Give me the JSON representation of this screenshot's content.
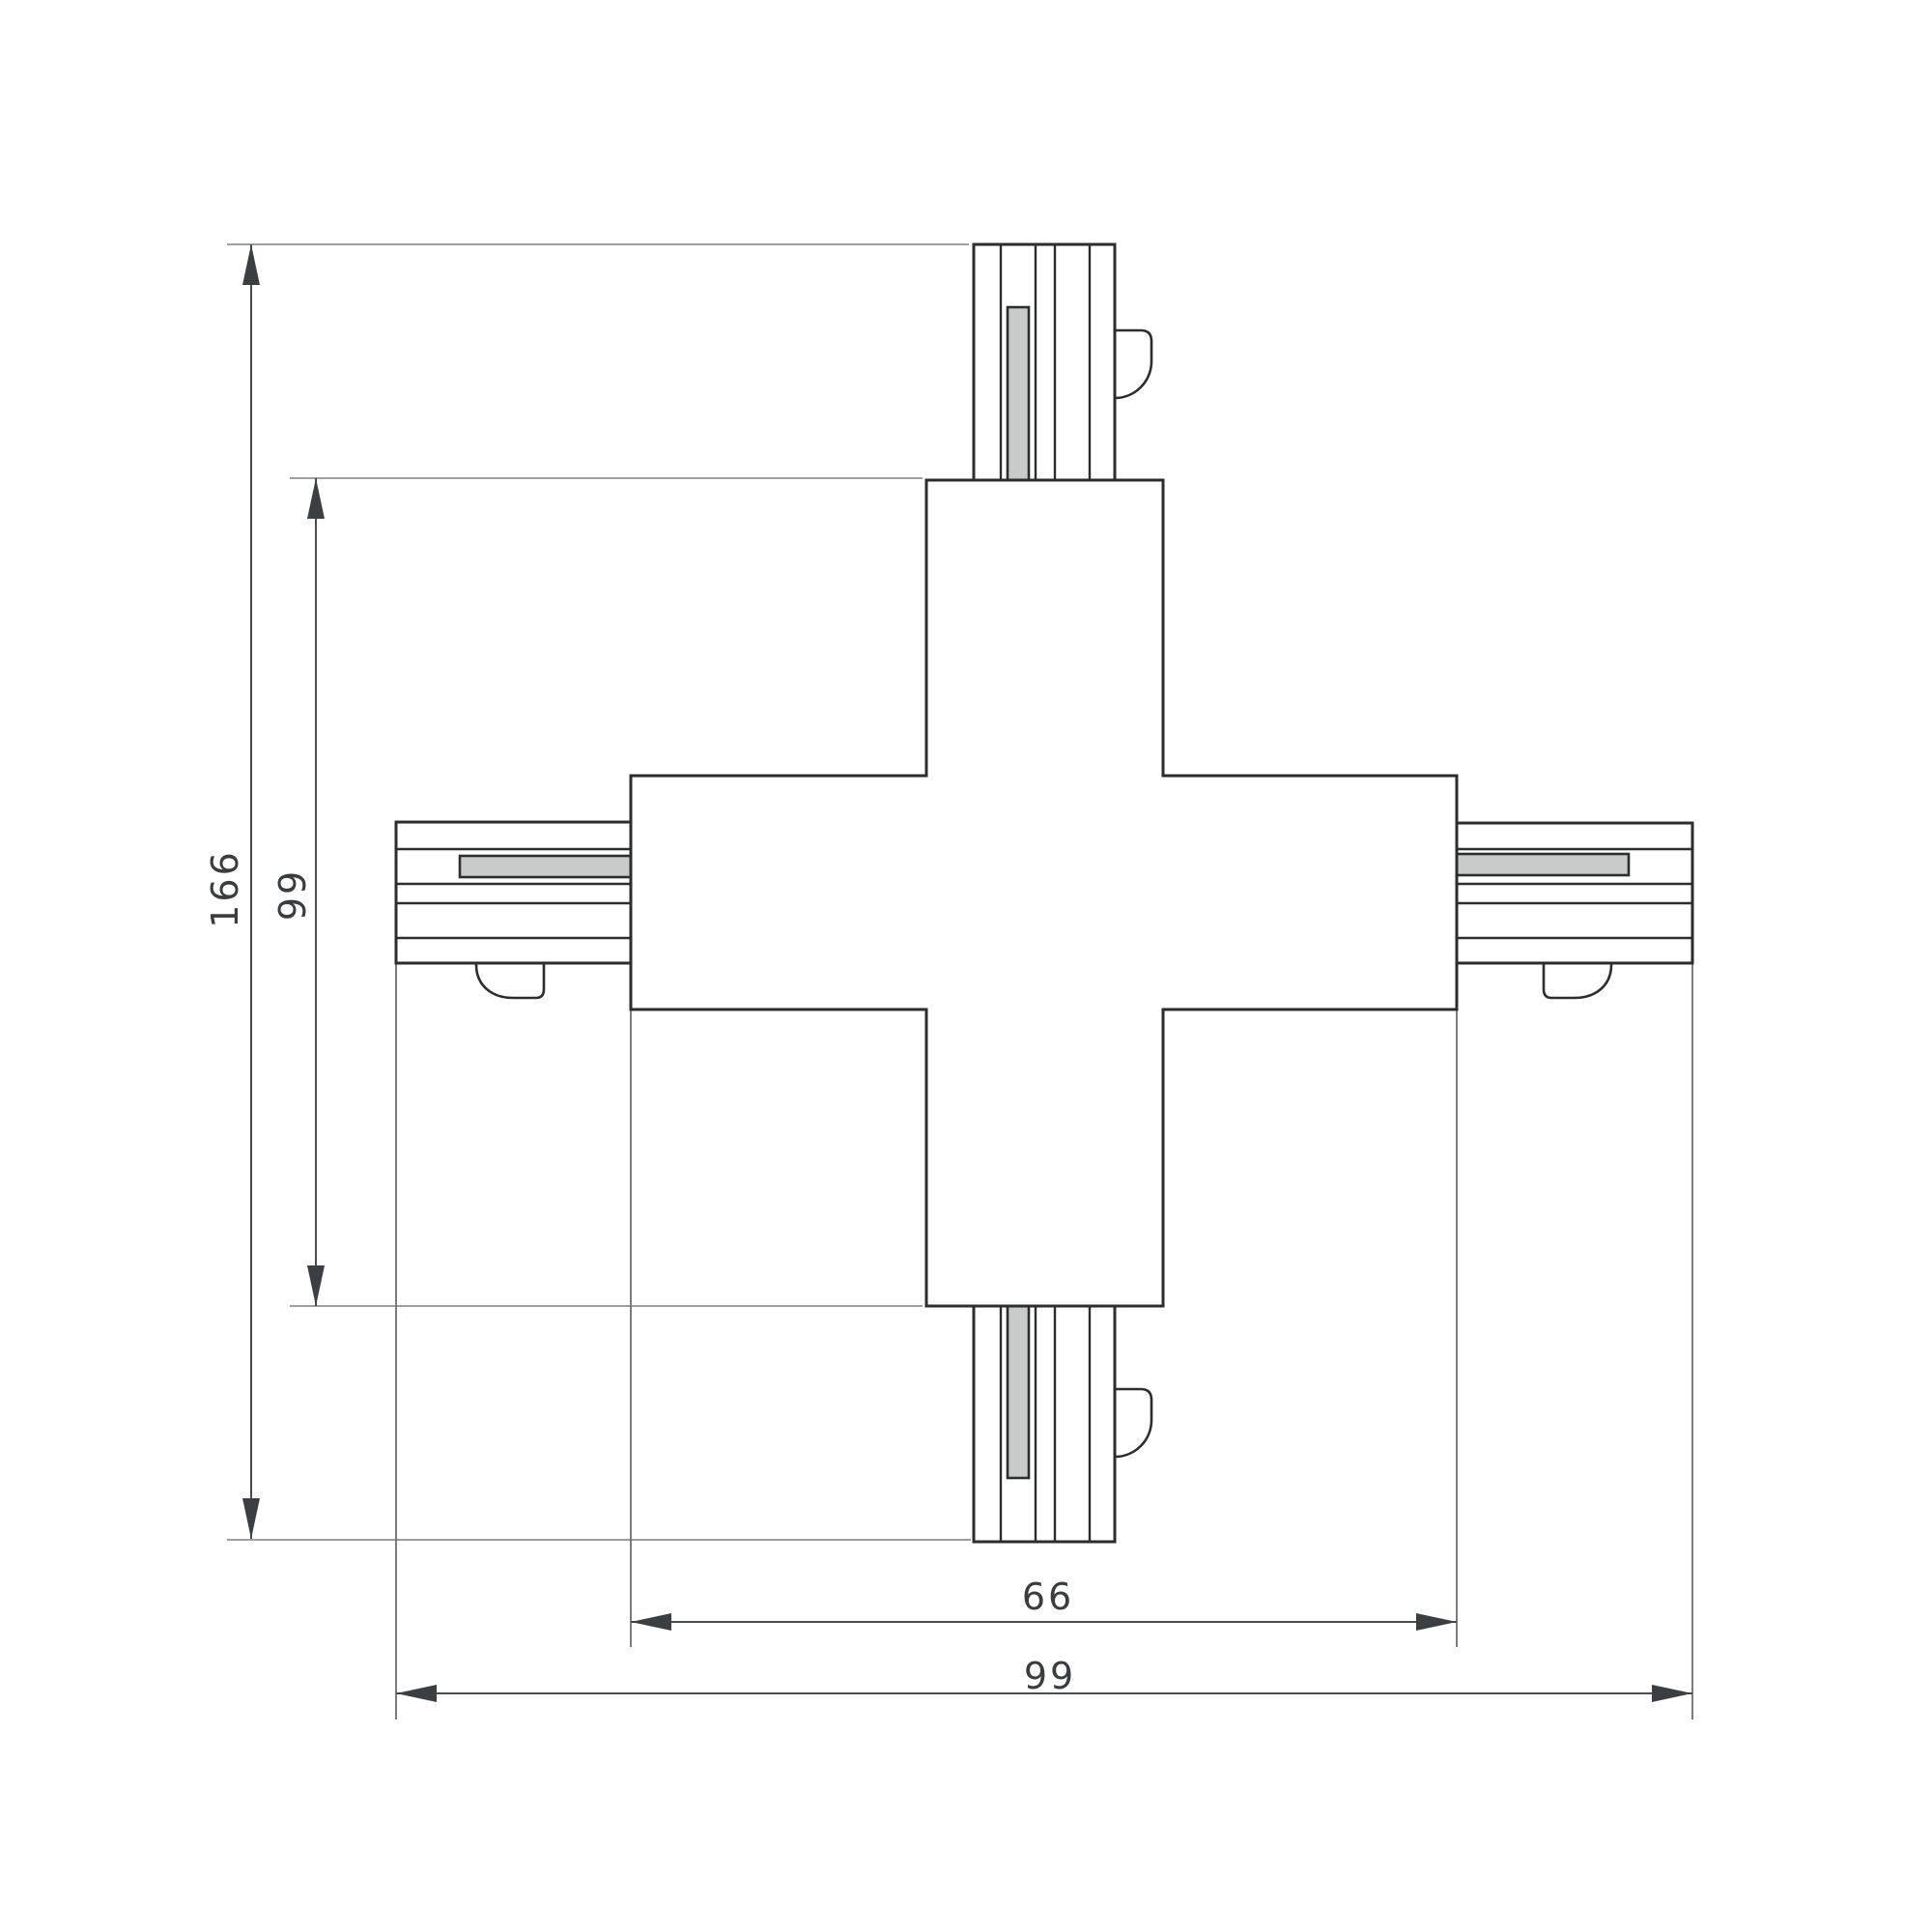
{
  "drawing": {
    "type": "technical-dimension-drawing",
    "subject": "X-shaped 4-way track connector, plan view",
    "background": "#ffffff",
    "colors": {
      "outline": "#2b2d2e",
      "dimension_line": "#4a4d4f",
      "extension_line": "#8e9192",
      "arrow_fill": "#3c3f41",
      "label_text": "#3a3d3f",
      "slot_fill": "#c9cbcb",
      "body_fill": "#ffffff"
    },
    "dimensions": {
      "overall_length": {
        "label": "166",
        "orientation": "vertical"
      },
      "body_length": {
        "label": "99",
        "orientation": "vertical"
      },
      "body_width": {
        "label": "66",
        "orientation": "horizontal"
      },
      "overall_width": {
        "label": "99",
        "orientation": "horizontal"
      }
    },
    "parts": {
      "center_body": "cross-shaped connector body",
      "couplers": [
        "top",
        "bottom",
        "left",
        "right"
      ],
      "coupler_features": [
        "ribbed track profile",
        "conductor slot (gray)",
        "release latch tab"
      ]
    }
  }
}
